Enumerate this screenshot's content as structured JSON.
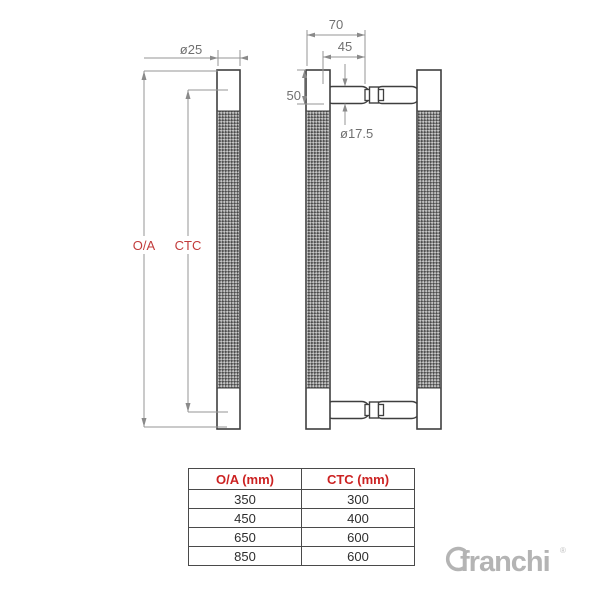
{
  "drawing": {
    "front_view": {
      "diameter_label": "ø25",
      "oa_label": "O/A",
      "ctc_label": "CTC"
    },
    "side_view": {
      "overall_depth_label": "70",
      "inner_depth_label": "45",
      "end_height_label": "50",
      "grip_diameter_label": "ø17.5"
    }
  },
  "table": {
    "headers": [
      "O/A (mm)",
      "CTC (mm)"
    ],
    "rows": [
      [
        "350",
        "300"
      ],
      [
        "450",
        "400"
      ],
      [
        "650",
        "600"
      ],
      [
        "850",
        "600"
      ]
    ]
  },
  "logo": {
    "text": "franchi",
    "mark": "®"
  },
  "colors": {
    "drawing_label_red": "#c23b3b",
    "table_header_red": "#cc2222",
    "outline_gray": "#3f3f3f",
    "dimension_gray": "#969696",
    "logo_gray": "#b4b4b4"
  }
}
